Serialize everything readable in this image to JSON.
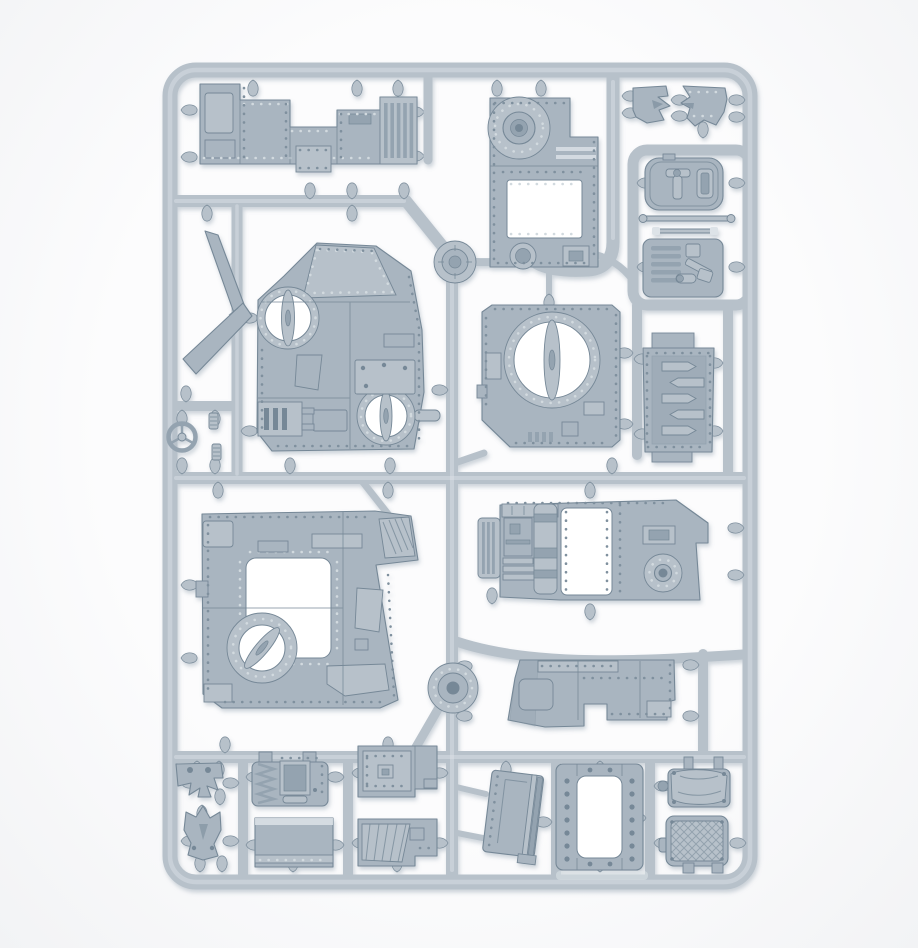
{
  "photo": {
    "subject": "Grey plastic model kit sprue with armoured-vehicle parts on a white background"
  },
  "palette": {
    "background": "#fcfcfd",
    "backdrop_edge": "#f2f3f5",
    "plastic": "#b7c1ca",
    "plastic_mid": "#a9b5c0",
    "plastic_dark": "#94a3b0",
    "plastic_line": "#768897",
    "plastic_light": "#dde3e8",
    "rivet_dark": "#7f909e",
    "rivet_light": "#d2dadf",
    "hole": "#ffffff",
    "shadow": "#7d8fa0"
  },
  "parts": [
    {
      "id": "sprue-frame",
      "label": "rectangular sprue frame with internal runners"
    },
    {
      "id": "runner-disc-upper",
      "label": "round runner boss, upper centre"
    },
    {
      "id": "runner-disc-lower",
      "label": "round runner boss, lower centre"
    },
    {
      "id": "hull-side-panel",
      "label": "riveted hull side panel with louvred end"
    },
    {
      "id": "hull-front-plate",
      "label": "hull front plate with circular gun mount and opening"
    },
    {
      "id": "glyph-plate-left",
      "label": "spiked glyph plate, left"
    },
    {
      "id": "glyph-plate-right",
      "label": "spiked glyph plate, right"
    },
    {
      "id": "hatch-door",
      "label": "hinged hatch door with handle and slot"
    },
    {
      "id": "axle-rod",
      "label": "long axle rod"
    },
    {
      "id": "link-rod",
      "label": "short linkage rod"
    },
    {
      "id": "vent-panel",
      "label": "stowage panel with vent slots and kit"
    },
    {
      "id": "cab-plate",
      "label": "cab armour plate with two circular hatch rings"
    },
    {
      "id": "turret-ring-plate",
      "label": "roof plate with large turret ring"
    },
    {
      "id": "louvre-door",
      "label": "armoured door with arrow louvres"
    },
    {
      "id": "exhaust-blade",
      "label": "angled exhaust deflector blade"
    },
    {
      "id": "steering-wheel",
      "label": "steering wheel"
    },
    {
      "id": "control-pegs",
      "label": "small knurled control pegs"
    },
    {
      "id": "roof-plate",
      "label": "hull roof plate with square opening and hatch ring"
    },
    {
      "id": "engine-bay",
      "label": "engine bay side with radiator, cylinder and drive hub"
    },
    {
      "id": "glacis-plate",
      "label": "riveted glacis plate with bottom notch"
    },
    {
      "id": "jaw-glyph-upper",
      "label": "toothed jaw glyph plate, upper"
    },
    {
      "id": "jaw-glyph-lower",
      "label": "spiked jaw glyph plate, lower"
    },
    {
      "id": "toothed-hatch",
      "label": "hatch cover with toothed trim"
    },
    {
      "id": "armour-slab",
      "label": "flat armour slab"
    },
    {
      "id": "stepped-plate-riveted",
      "label": "stepped armour plate, riveted"
    },
    {
      "id": "stepped-plate-planked",
      "label": "stepped armour plate, planked"
    },
    {
      "id": "side-door",
      "label": "slanted side door with hinge bar"
    },
    {
      "id": "door-frame",
      "label": "bolted door frame"
    },
    {
      "id": "tarp-crate",
      "label": "tarpaulin-covered crate"
    },
    {
      "id": "tread-hatch",
      "label": "treadplate hatch cover"
    },
    {
      "id": "molded-code",
      "label": "faint molded code strip on bottom rail"
    }
  ]
}
